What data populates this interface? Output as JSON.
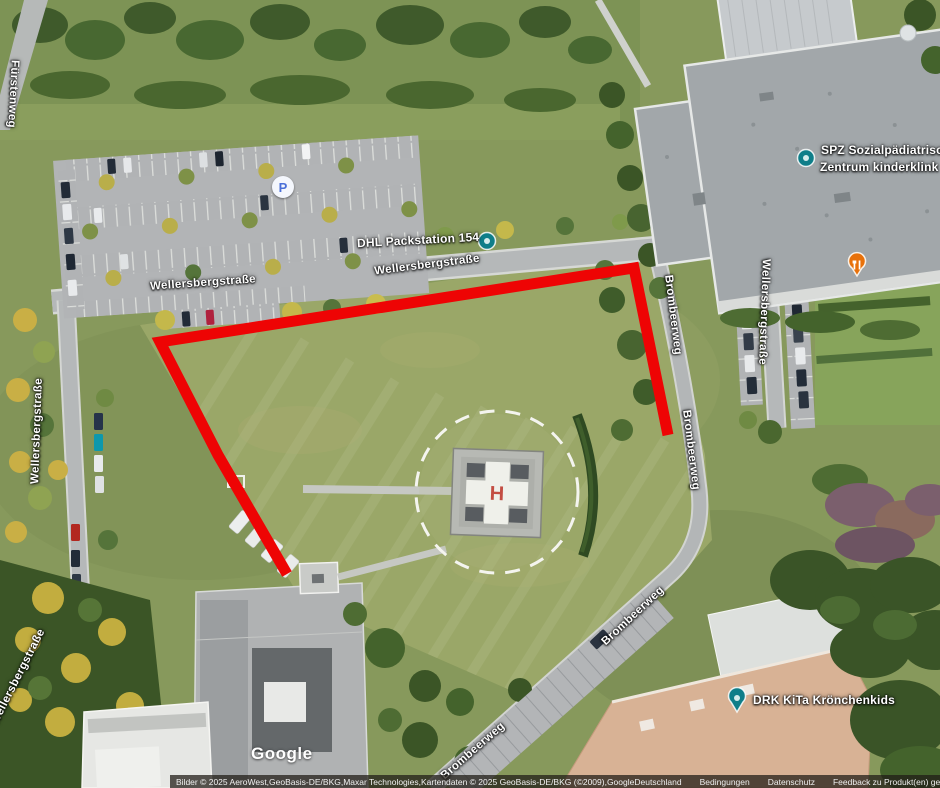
{
  "streets": {
    "fuerstenweg": "Fürstenweg",
    "wellersbergstrasse": "Wellersbergstraße",
    "brombeerweg": "Brombeerweg"
  },
  "pois": {
    "parking": {
      "glyph": "P"
    },
    "dhl": {
      "label": "DHL Packstation 154"
    },
    "spz": {
      "line1": "SPZ Sozialpädiatrische",
      "line2": "Zentrum kinderklink"
    },
    "drk": {
      "label": "DRK KiTa Krönchenkids"
    }
  },
  "icons": {
    "poi_pin": "map-pin",
    "parking": "parking-circle-p",
    "restaurant": "fork-knife"
  },
  "helipad": {
    "letter": "H"
  },
  "annotation": {
    "shape": "open red polyline outlining grass field"
  },
  "watermark": "Google",
  "attribution": {
    "copyright": "Bilder © 2025 AeroWest,GeoBasis-DE/BKG,Maxar Technologies,Kartendaten © 2025 GeoBasis-DE/BKG (©2009),Google",
    "links": [
      "Deutschland",
      "Bedingungen",
      "Datenschutz",
      "Feedback zu Produkt(en) geben"
    ]
  },
  "colors": {
    "annotation_red": "#ee0404",
    "poi_teal": "#0f7e89",
    "restaurant_orange": "#e8710a",
    "parking_blue": "#4a6fd8"
  }
}
